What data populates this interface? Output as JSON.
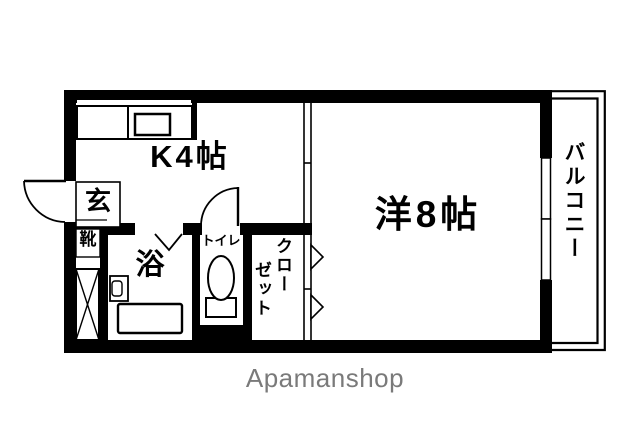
{
  "plan": {
    "kitchen": {
      "label": "K4帖"
    },
    "western_room": {
      "label": "洋8帖"
    },
    "balcony": {
      "label": "バルコニー"
    },
    "entrance": {
      "label": "玄"
    },
    "shoe_cabinet": {
      "label": "靴"
    },
    "bath": {
      "label": "浴"
    },
    "toilet": {
      "label": "トイレ"
    },
    "closet": {
      "label": "クローゼット",
      "label_lines": [
        "クロー",
        "ゼット"
      ]
    }
  },
  "watermark": {
    "text": "Apamanshop",
    "color": "#7a7a7a"
  },
  "colors": {
    "wall": "#000000",
    "background": "#ffffff"
  }
}
